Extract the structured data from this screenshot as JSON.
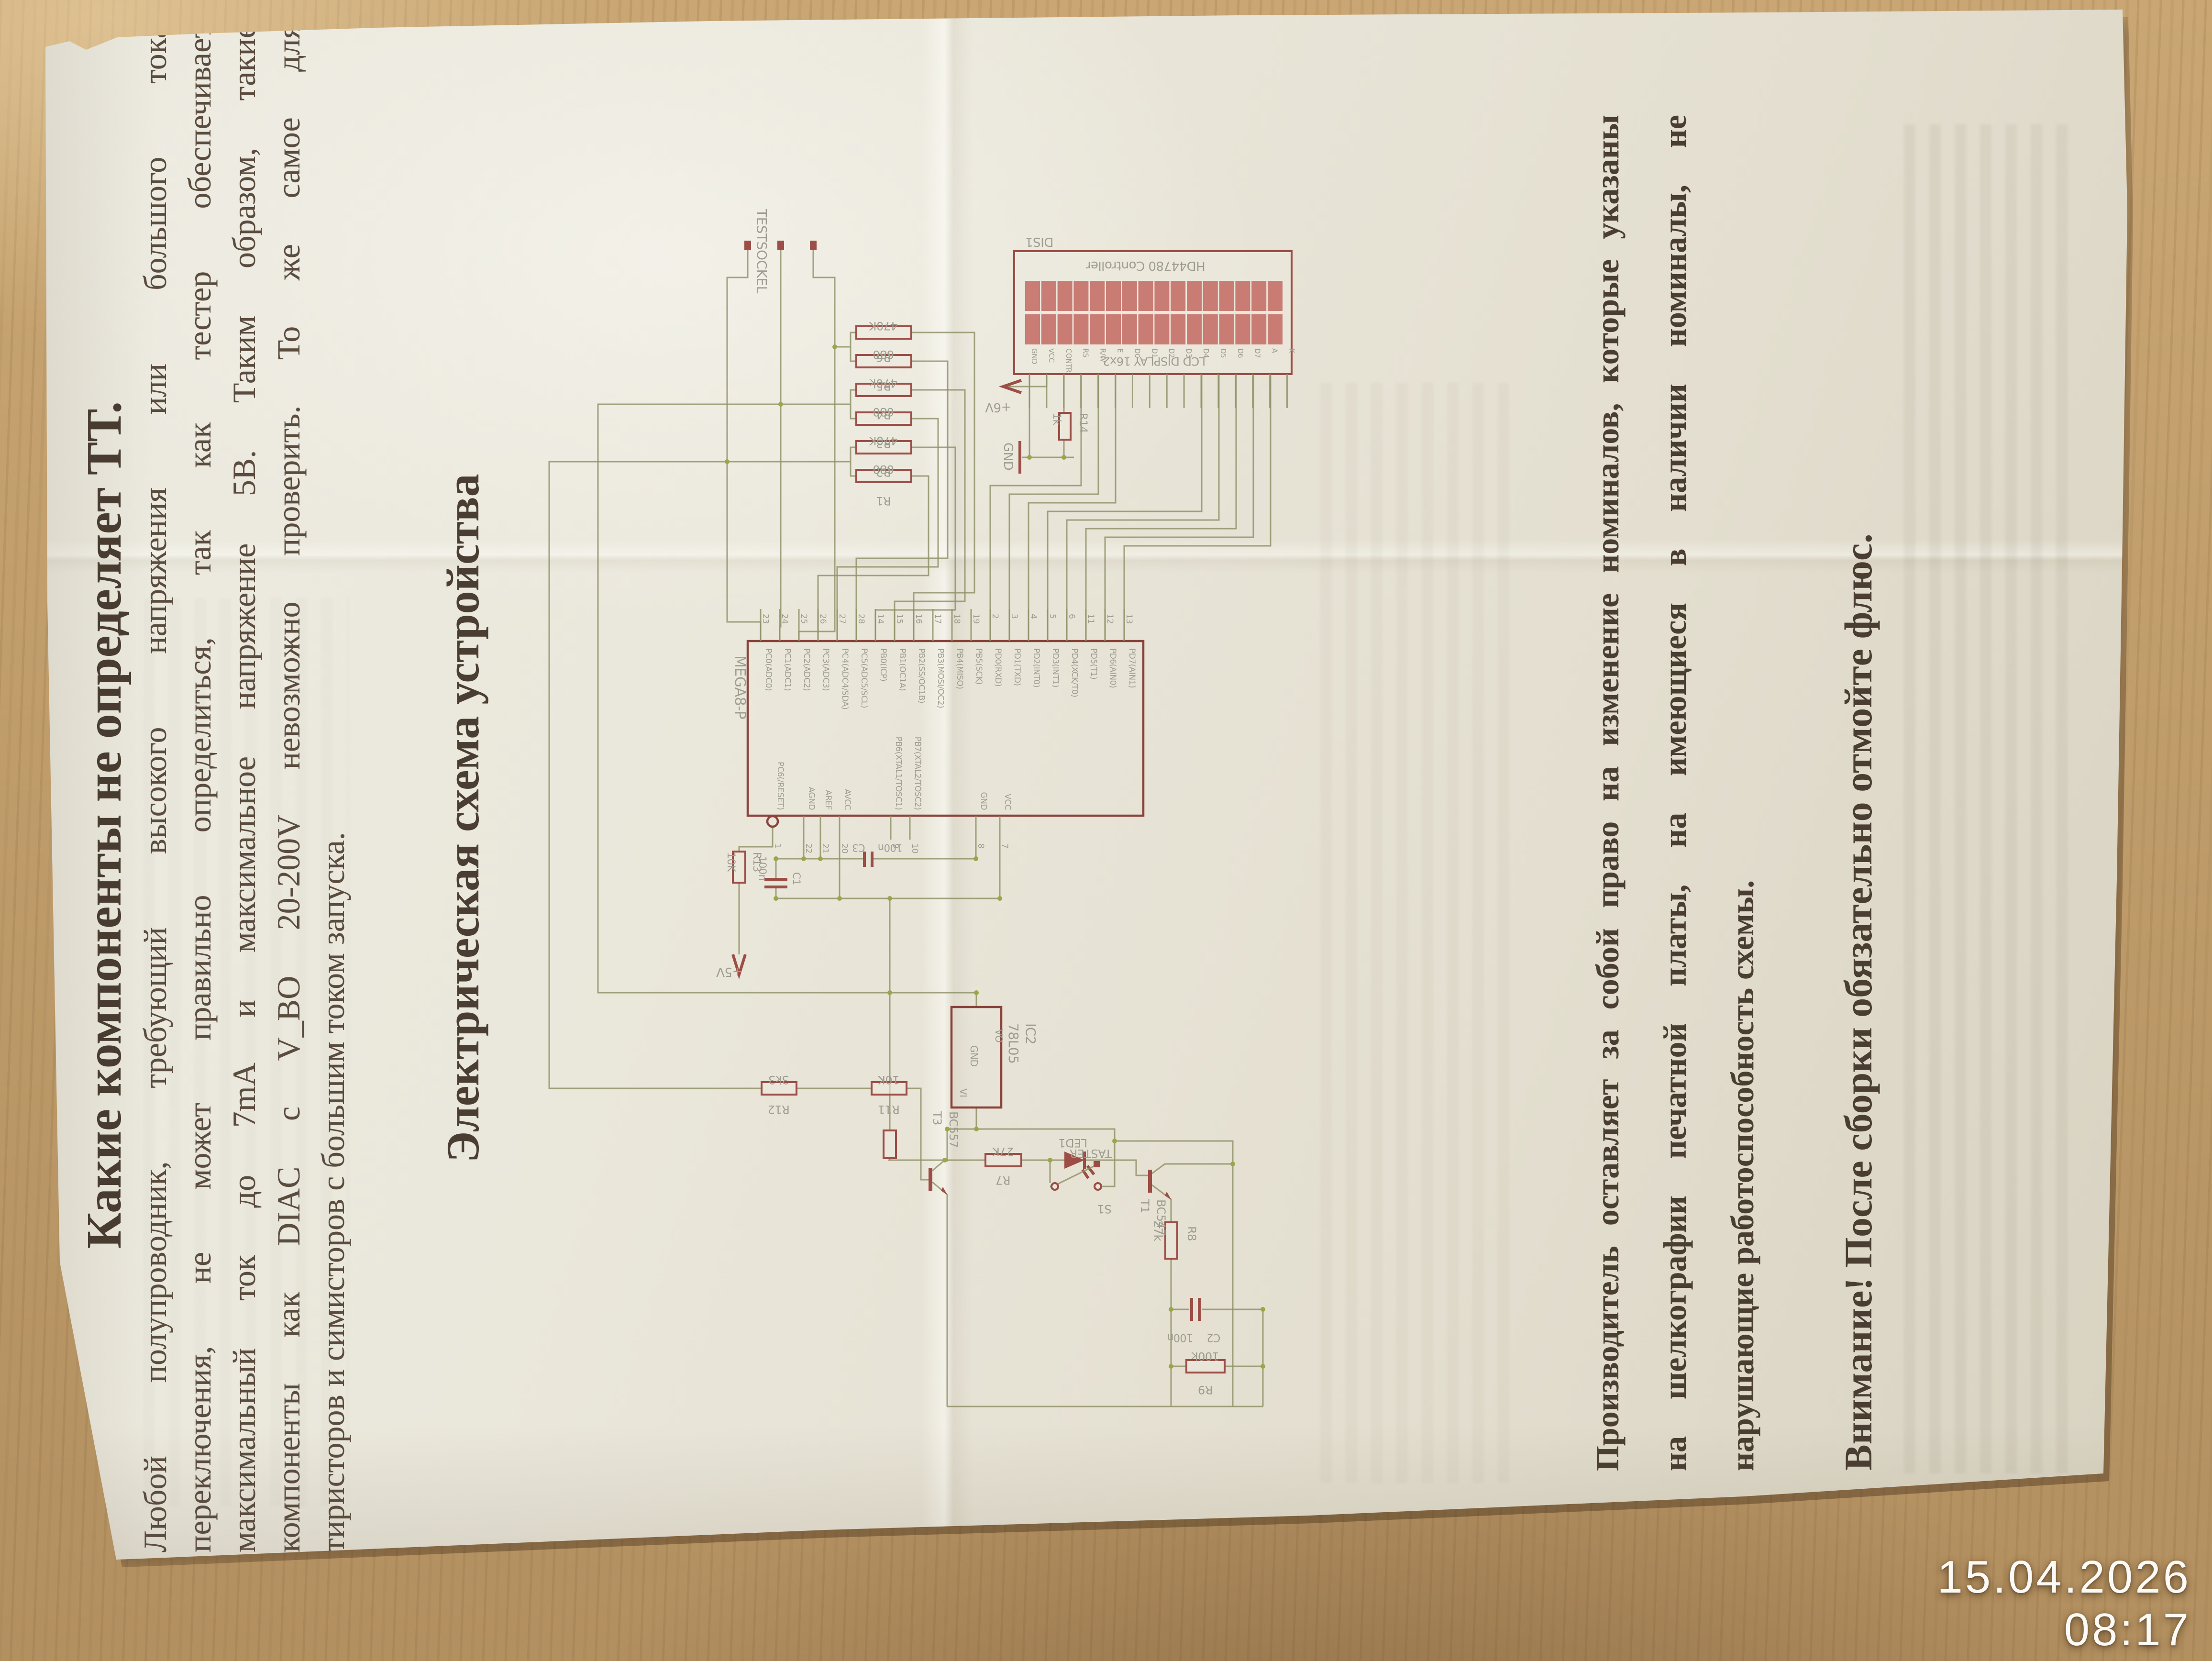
{
  "photo": {
    "timestamp": "15.04.2026 08:17"
  },
  "document": {
    "title": "Какие компоненты не определяет ТТ.",
    "paragraph_lines": [
      "Любой полупроводник, требующий высокого напряжения или большого тока",
      "переключения, не может правильно определиться, так как тестер обеспечивает",
      "максимальный ток до 7mA и максимальное напряжение 5В. Таким образом, такие",
      "компоненты как DIAC с V_BO 20-200V невозможно проверить. То же самое для",
      "тиристоров и симисторов с большим током запуска."
    ],
    "section_heading": "Электрическая схема устройства",
    "manufacturer_note_lines": [
      "Производитель оставляет за собой право на изменение номиналов, которые указаны",
      "на шелкографии печатной платы, на имеющиеся в наличии номиналы, не",
      "нарушающие работоспособность схемы."
    ],
    "attention_note": "Внимание! После сборки обязательно отмойте флюс."
  },
  "schematic": {
    "socket_label": "TESTSOCKEL",
    "display": {
      "designator": "DIS1",
      "controller": "HD44780 Controller",
      "type_label": "LCD DISPLAY 16x2",
      "rows": 2,
      "cols": 16,
      "pin_labels": [
        "GND",
        "VCC",
        "CONTR",
        "RS",
        "R/W",
        "E",
        "D0",
        "D1",
        "D2",
        "D3",
        "D4",
        "D5",
        "D6",
        "D7",
        "A",
        "K"
      ]
    },
    "mcu": {
      "name": "MEGA8-P",
      "top_pins": [
        {
          "num": "23",
          "label": "PC0(ADC0)"
        },
        {
          "num": "24",
          "label": "PC1(ADC1)"
        },
        {
          "num": "25",
          "label": "PC2(ADC2)"
        },
        {
          "num": "26",
          "label": "PC3(ADC3)"
        },
        {
          "num": "27",
          "label": "PC4(ADC4/SDA)"
        },
        {
          "num": "28",
          "label": "PC5(ADC5/SCL)"
        },
        {
          "num": "14",
          "label": "PB0(ICP)"
        },
        {
          "num": "15",
          "label": "PB1(OC1A)"
        },
        {
          "num": "16",
          "label": "PB2(SS/OC1B)"
        },
        {
          "num": "17",
          "label": "PB3(MOSI/OC2)"
        },
        {
          "num": "18",
          "label": "PB4(MISO)"
        },
        {
          "num": "19",
          "label": "PB5(SCK)"
        },
        {
          "num": "2",
          "label": "PD0(RXD)"
        },
        {
          "num": "3",
          "label": "PD1(TXD)"
        },
        {
          "num": "4",
          "label": "PD2(INT0)"
        },
        {
          "num": "5",
          "label": "PD3(INT1)"
        },
        {
          "num": "6",
          "label": "PD4(XCK/T0)"
        },
        {
          "num": "11",
          "label": "PD5(T1)"
        },
        {
          "num": "12",
          "label": "PD6(AIN0)"
        },
        {
          "num": "13",
          "label": "PD7(AIN1)"
        }
      ],
      "bottom_pins": [
        {
          "num": "1",
          "label": "PC6(/RESET)"
        },
        {
          "num": "22",
          "label": "AGND"
        },
        {
          "num": "21",
          "label": "AREF"
        },
        {
          "num": "20",
          "label": "AVCC"
        },
        {
          "num": "9",
          "label": "PB6(XTAL1/TOSC1)"
        },
        {
          "num": "10",
          "label": "PB7(XTAL2/TOSC2)"
        },
        {
          "num": "8",
          "label": "GND"
        },
        {
          "num": "7",
          "label": "VCC"
        }
      ]
    },
    "ladder": [
      {
        "name": "R1",
        "value": "680"
      },
      {
        "name": "R2",
        "value": "470K"
      },
      {
        "name": "R3",
        "value": "680"
      },
      {
        "name": "R4",
        "value": "470k"
      },
      {
        "name": "R5",
        "value": "680"
      },
      {
        "name": "R6",
        "value": "470K"
      }
    ],
    "components": {
      "r7": {
        "name": "R7",
        "value": "27K"
      },
      "r8": {
        "name": "R8",
        "value": "27k"
      },
      "r9": {
        "name": "R9",
        "value": "100k"
      },
      "r11": {
        "name": "R11",
        "value": "10K"
      },
      "r12": {
        "name": "R12",
        "value": "3k3"
      },
      "r13": {
        "name": "R13",
        "value": "10K"
      },
      "r14": {
        "name": "R14",
        "value": "1k"
      },
      "c1": {
        "name": "C1",
        "value": "100n"
      },
      "c2": {
        "name": "C2",
        "value": "100n"
      },
      "c3": {
        "name": "C3",
        "value": "100n"
      },
      "ic2": {
        "name": "IC2",
        "value": "78L05",
        "pin_vi": "VI",
        "pin_vo": "VO",
        "pin_gnd": "GND"
      },
      "t1": {
        "name": "T1",
        "value": "BC547"
      },
      "t3": {
        "name": "T3",
        "value": "BC557"
      },
      "led1": {
        "name": "LED1"
      },
      "s1": {
        "name": "S1",
        "label": "TASTER"
      }
    },
    "nets": {
      "gnd": "GND",
      "p5": "+5V",
      "p6": "+6V"
    }
  },
  "colors": {
    "wood": "#bd9a68",
    "paper": "#e9e5da",
    "print_text": "#57493c",
    "schematic_wire": "#8a8c60",
    "schematic_component": "#96413a",
    "lcd_cell": "#c2635c",
    "junction_dot": "#93a23e",
    "timestamp": "#fbfaf6"
  }
}
